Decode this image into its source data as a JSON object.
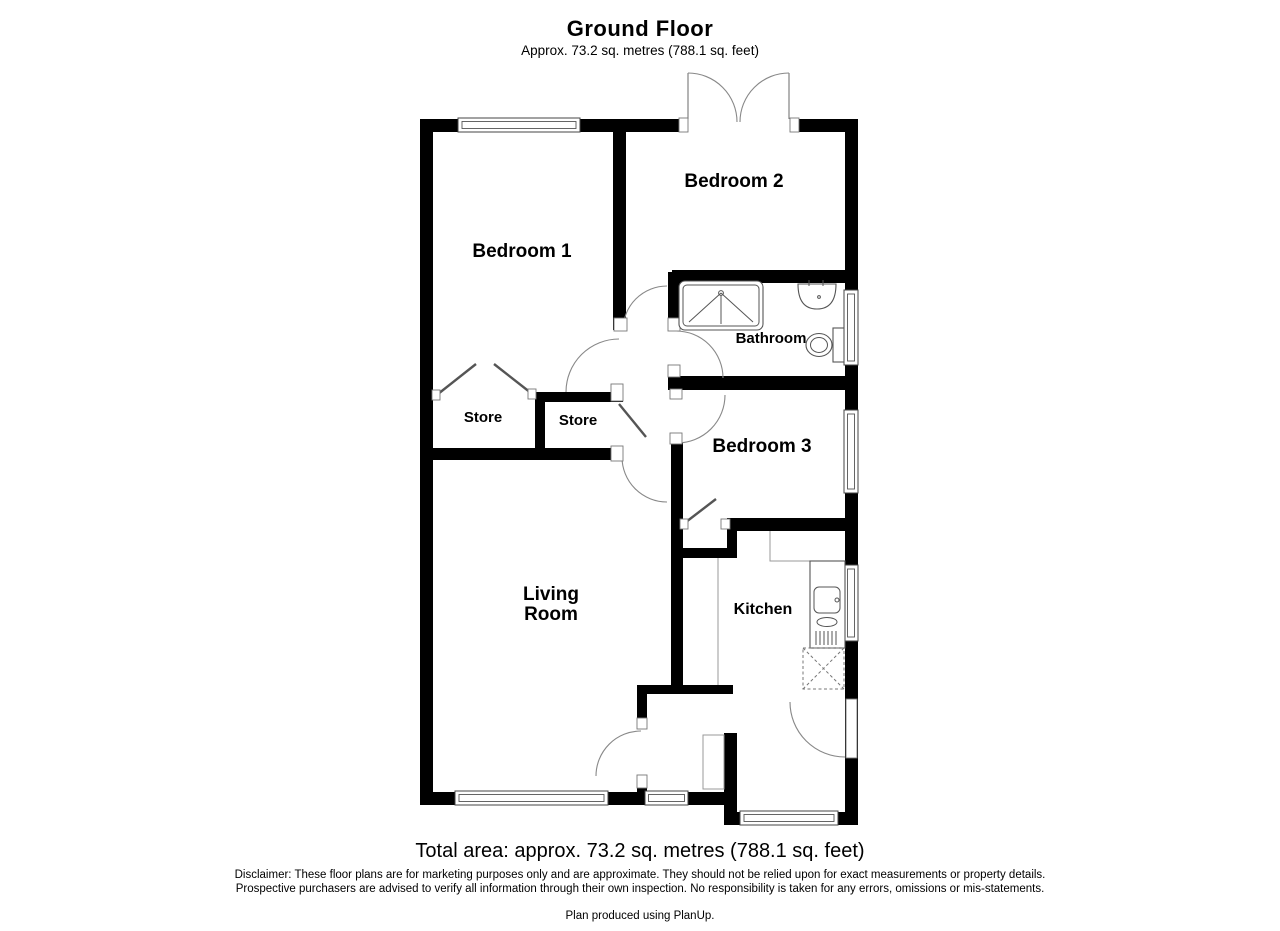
{
  "header": {
    "title": "Ground Floor",
    "subtitle": "Approx. 73.2 sq. metres (788.1 sq. feet)"
  },
  "rooms": {
    "bedroom1": "Bedroom 1",
    "bedroom2": "Bedroom 2",
    "bedroom3": "Bedroom 3",
    "bathroom": "Bathroom",
    "store1": "Store",
    "store2": "Store",
    "living_line1": "Living",
    "living_line2": "Room",
    "kitchen": "Kitchen"
  },
  "footer": {
    "total_area": "Total area: approx. 73.2 sq. metres (788.1 sq. feet)",
    "disclaimer": "Disclaimer: These floor plans are for marketing purposes only and are approximate. They should not be relied upon for exact measurements or property details. Prospective purchasers are advised to verify all information through their own inspection. No responsibility is taken for any errors, omissions or mis-statements.",
    "credit": "Plan produced using PlanUp."
  },
  "colors": {
    "wall": "#000000",
    "background": "#ffffff",
    "line": "#888888"
  }
}
